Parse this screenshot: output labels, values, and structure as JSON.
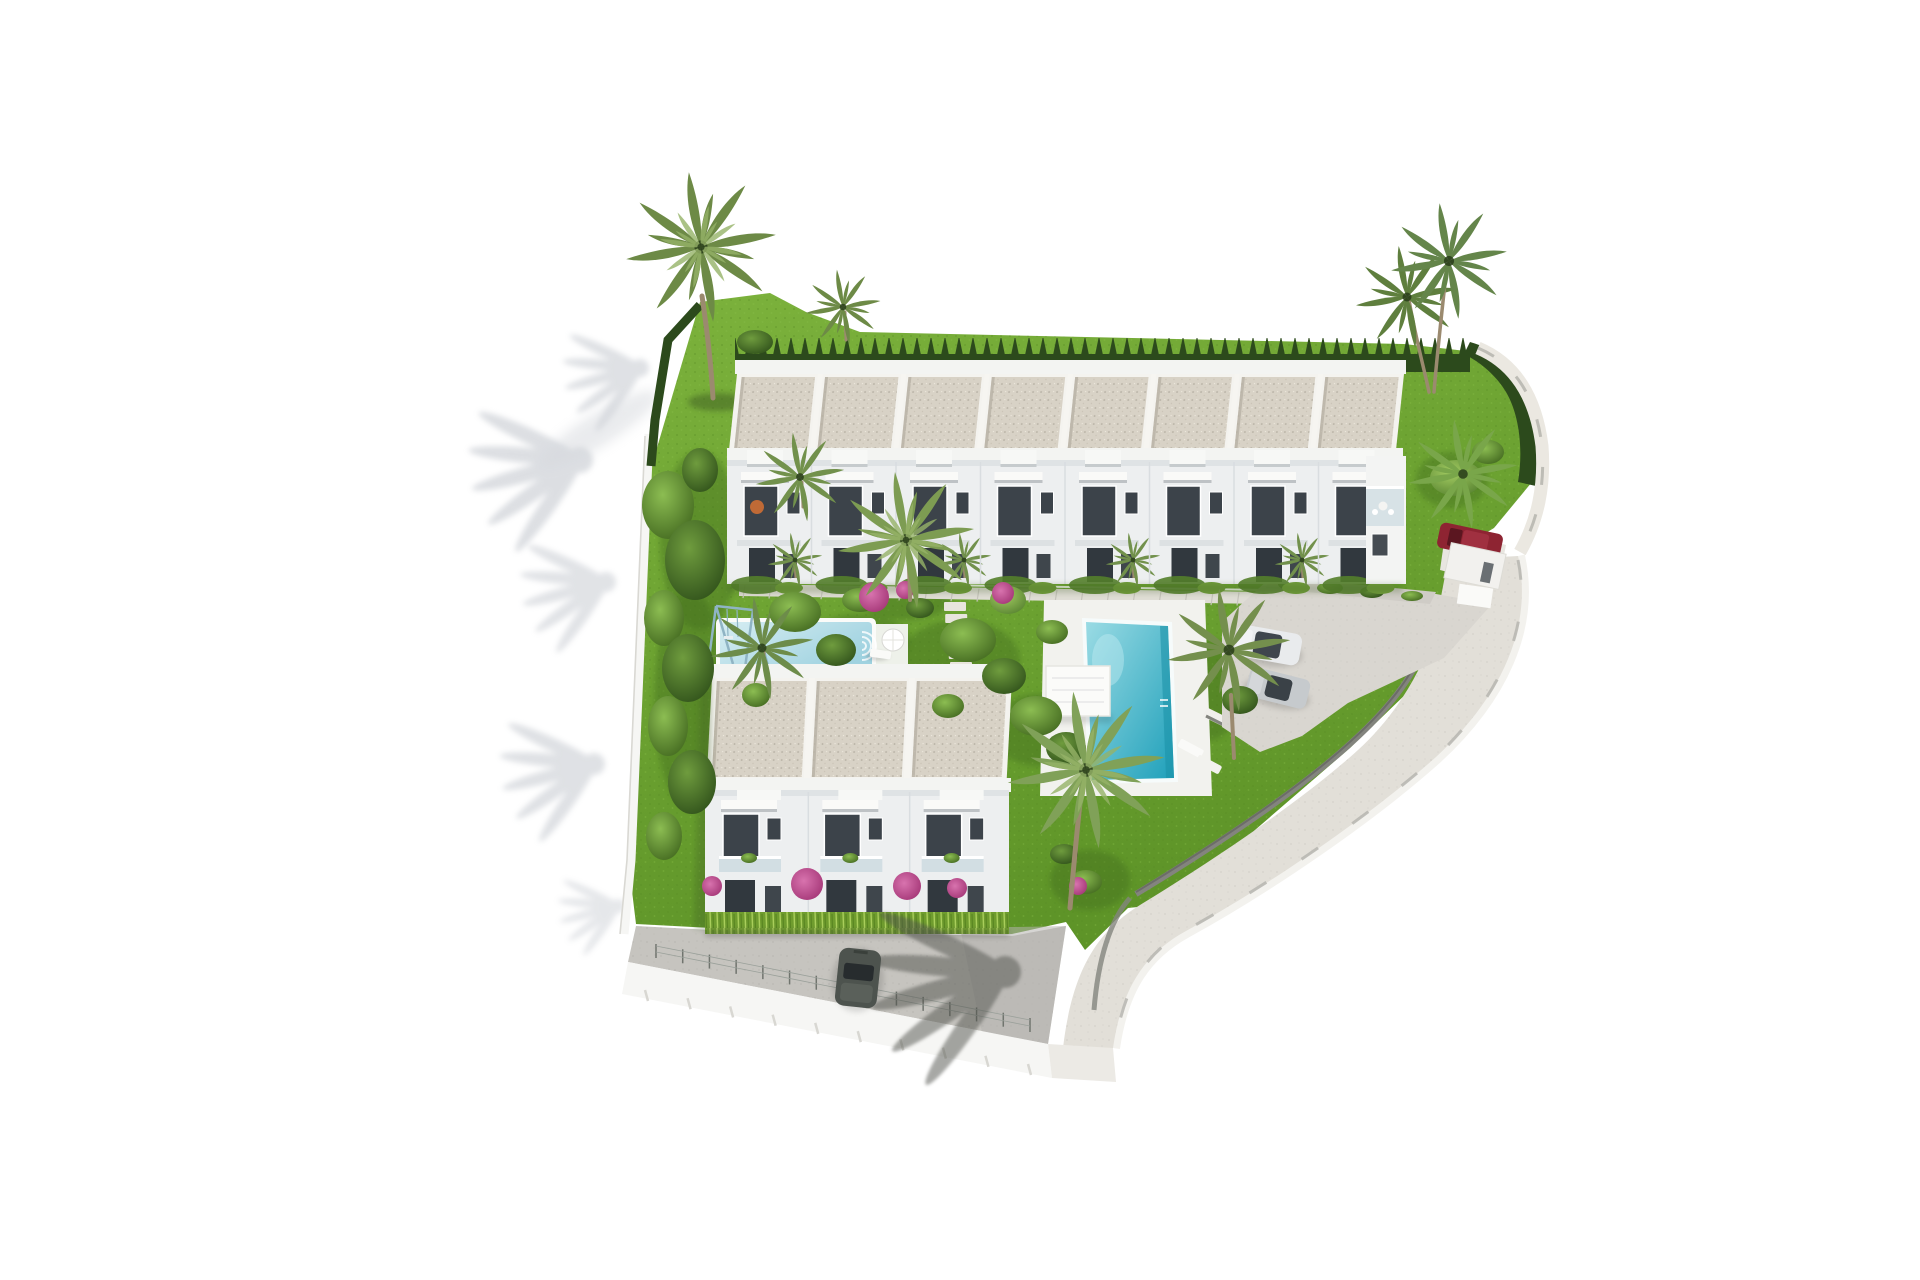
{
  "scene": {
    "type": "aerial-3d-architectural-render",
    "description": "Aerial isometric rendering of a white-townhouse residential development with gardens, two pools, parking, perimeter road and palm trees on a white background",
    "top_row_units": 8,
    "lower_block_units": 3,
    "pools": [
      "main-pool",
      "kids-pool"
    ],
    "vehicles": [
      "silver-coupe",
      "silver-sedan",
      "dark-suv",
      "red-car"
    ],
    "amenities": [
      "swing-set",
      "pergola",
      "sun-loungers",
      "parasol",
      "parking-area",
      "garden-paths"
    ]
  },
  "colors": {
    "background": "#ffffff",
    "grass_light": "#7cb23c",
    "grass": "#5e9428",
    "grass_dark": "#3f6a1e",
    "hedge": "#2c4a1c",
    "hedge_lite_base": "#6f9c2e",
    "hedge_lite_hi": "#a9ce5b",
    "roof": "#d8d2c6",
    "roof_speck": "#b8b2a5",
    "parapet": "#f3f4f2",
    "facade": "#edeff0",
    "facade_shade": "#dfe3e5",
    "window": "#3c434a",
    "window_dark": "#31383e",
    "glass_balcony": "#ccdbe0",
    "path": "#dfddd5",
    "paver_joint": "#c6c4bc",
    "road": "#c6c4bf",
    "road_light": "#e2dfd8",
    "parking": "#d9d6d0",
    "wall_white": "#f6f6f4",
    "wall_gray": "#83847e",
    "wall_cap_dark": "#6c6d68",
    "pool_light": "#9adbe4",
    "pool_deep": "#1fa0ba",
    "kids_pool_light": "#d6edf2",
    "kids_pool_deep": "#9fd2e0",
    "deck": "#f2f2ee",
    "pergola": "#fbfbf9",
    "palm_green": "#6d8a46",
    "palm_bright": "#79a64a",
    "tree_green": "#4e7d2f",
    "trunk": "#9b8a6f",
    "bougainvillea": "#b23a7e",
    "orange_flower": "#c06a36",
    "car_silver": "#e9ebed",
    "car_gray": "#c6cacd",
    "car_dark": "#4d534e",
    "car_red": "#8e2432",
    "shadow_cool": "#aab0ba",
    "shadow_ground": "#51524e"
  }
}
